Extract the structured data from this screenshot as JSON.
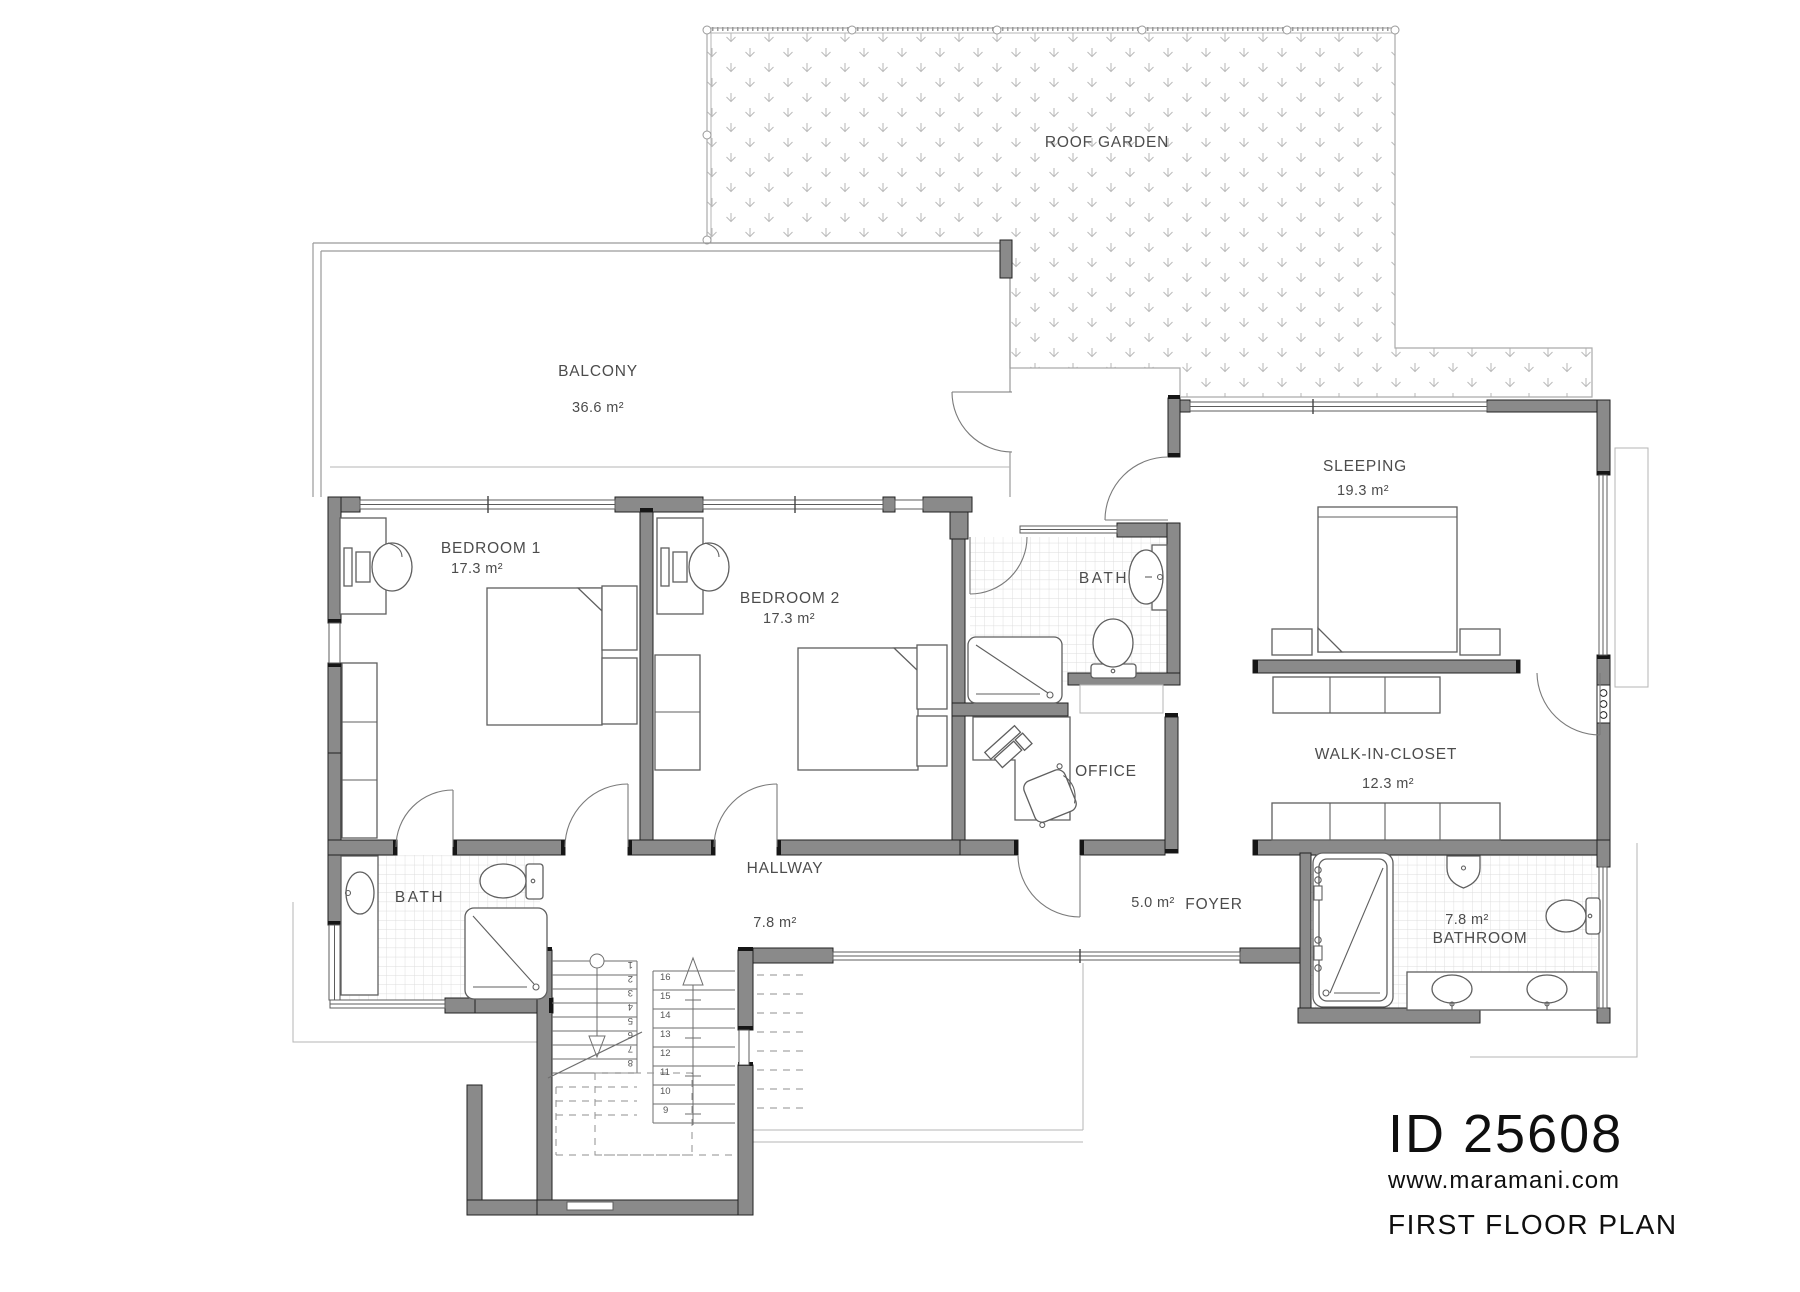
{
  "title_block": {
    "plan_id": "ID 25608",
    "website": "www.maramani.com",
    "plan_name": "FIRST FLOOR PLAN"
  },
  "rooms": {
    "roof_garden": {
      "label": "ROOF GARDEN"
    },
    "balcony": {
      "label": "BALCONY",
      "area": "36.6 m²"
    },
    "bedroom1": {
      "label": "BEDROOM 1",
      "area": "17.3 m²"
    },
    "bedroom2": {
      "label": "BEDROOM 2",
      "area": "17.3 m²"
    },
    "bath_ensuite_top": {
      "label": "BATH"
    },
    "bath_ensuite_left": {
      "label": "BATH"
    },
    "sleeping": {
      "label": "SLEEPING",
      "area": "19.3 m²"
    },
    "office": {
      "label": "OFFICE"
    },
    "walk_in_closet": {
      "label": "WALK-IN-CLOSET",
      "area": "12.3 m²"
    },
    "hallway": {
      "label": "HALLWAY",
      "area": "7.8 m²"
    },
    "foyer": {
      "label": "FOYER",
      "area": "5.0 m²"
    },
    "bathroom": {
      "label": "BATHROOM",
      "area": "7.8 m²"
    }
  },
  "stairs": {
    "steps": [
      "1",
      "2",
      "3",
      "4",
      "5",
      "6",
      "7",
      "8",
      "9",
      "10",
      "11",
      "12",
      "13",
      "14",
      "15",
      "16"
    ]
  },
  "colors": {
    "wall_fill": "#8a8a8a",
    "wall_edge": "#222222",
    "furniture_line": "#5f5f5f",
    "thin_line": "#9a9a9a",
    "tile_line": "#dcdcdc",
    "hatch_symbol": "#bdbdbd",
    "label_text": "#4c4c4c",
    "title_text": "#0f0f0f"
  }
}
